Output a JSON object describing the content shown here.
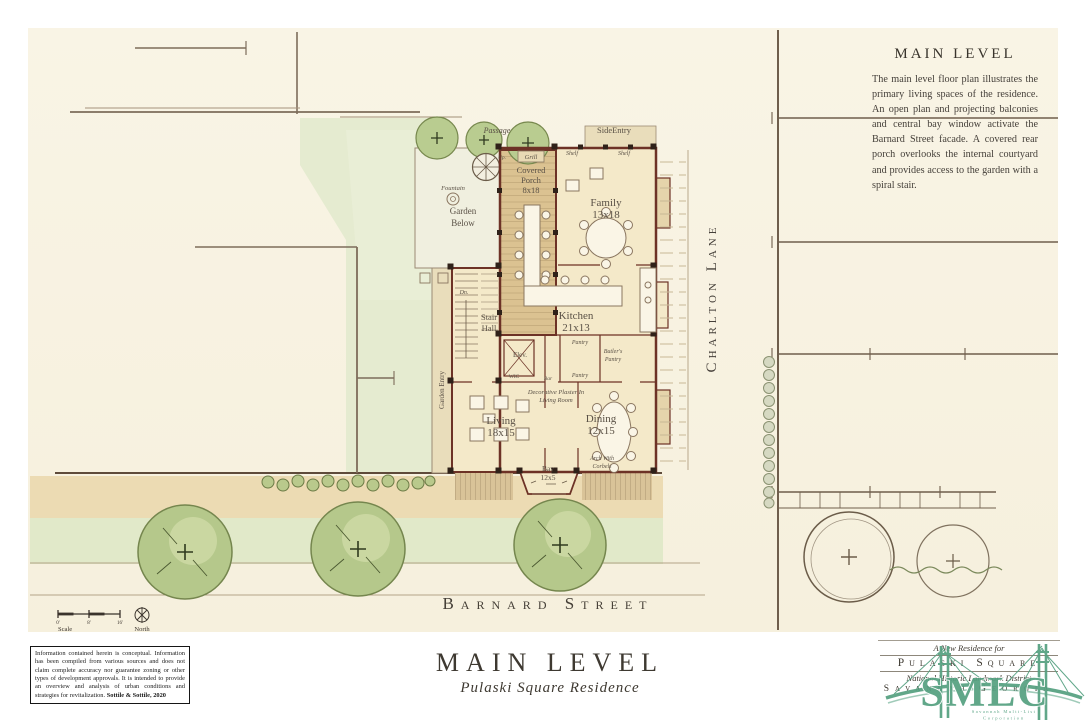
{
  "palette": {
    "paper": "#f8f3e2",
    "lawn": "#e5ebd0",
    "tree_green": "#b5c88b",
    "wall_maroon": "#6d3226",
    "deck_tan": "#dbc291",
    "floor_cream": "#f4e9c9",
    "logo_green": "#54a080"
  },
  "description_panel": {
    "title": "MAIN LEVEL",
    "body": "The main level floor plan illustrates the primary living spaces of the residence. An open plan and projecting balconies and central bay window activate the Barnard Street facade. A covered rear porch overlooks the internal courtyard and provides access to the garden with a spiral stair."
  },
  "streets": {
    "charlton": "Charlton Lane",
    "barnard": "Barnard Street"
  },
  "plan": {
    "passage": "Passage",
    "side_entry": "SideEntry",
    "grill": "Grill",
    "shelf": "Shelf",
    "covered_porch": [
      "Covered",
      "Porch",
      "8x18"
    ],
    "family": [
      "Family",
      "13x18"
    ],
    "fountain": "Fountain",
    "garden_below": [
      "Garden",
      "Below"
    ],
    "up": "Up.",
    "dn": "Dn.",
    "kitchen": [
      "Kitchen",
      "21x13"
    ],
    "stair_hall": [
      "Stair",
      "Hall"
    ],
    "elev": "Elev.",
    "pantry": "Pantry",
    "butlers_pantry": [
      "Butler's",
      "Pantry"
    ],
    "wic": "WIC",
    "bar": "Bar",
    "garden_entry": "Garden Entry",
    "decorative_plaster": [
      "Decorative Plaster In",
      "Living Room"
    ],
    "living": [
      "Living",
      "18x15"
    ],
    "dining": [
      "Dining",
      "12x15"
    ],
    "bay": [
      "Bay",
      "12x5"
    ],
    "arch": [
      "Arch With",
      "Corbels"
    ]
  },
  "legend": {
    "scale_label": "Scale",
    "north_label": "North",
    "ticks": [
      "0'",
      "8'",
      "16'"
    ]
  },
  "title_block": {
    "disclaimer": "Information contained herein is conceptual. Information has been compiled from various sources and does not claim complete accuracy nor guarantee zoning or other types of development approvals. It is intended to provide an overview and analysis of urban conditions and strategies for revitalization. ",
    "disclaimer_credit": "Sottile & Sottile, 2020",
    "title": "MAIN LEVEL",
    "subtitle": "Pulaski Square Residence"
  },
  "branding": {
    "tagline": "A New Residence for",
    "name": "Pulaski Square",
    "district": "National Historic Landmark District",
    "city": "Savannah Georgia",
    "logo_text": "SMLC",
    "logo_caption_1": "Savannah Multi-List",
    "logo_caption_2": "Corporation"
  }
}
